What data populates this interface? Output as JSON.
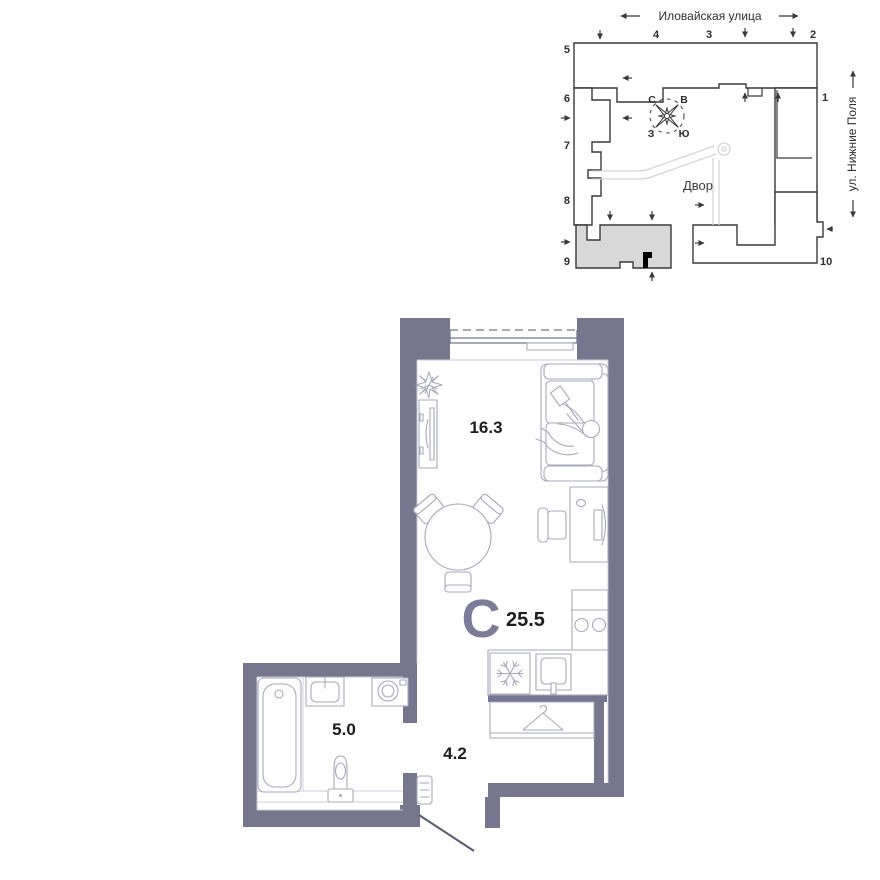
{
  "site_plan": {
    "street_top": {
      "label": "Иловайская улица"
    },
    "street_right": {
      "label": "ул. Нижние Поля"
    },
    "courtyard": {
      "label": "Двор"
    },
    "compass": {
      "north": "С",
      "east": "В",
      "west": "З",
      "south": "Ю"
    },
    "building_numbers": [
      "1",
      "2",
      "3",
      "4",
      "5",
      "6",
      "7",
      "8",
      "9",
      "10"
    ]
  },
  "floor_plan": {
    "apartment_type_letter": "С",
    "total_area": "25.5",
    "rooms": [
      {
        "name": "living-room",
        "area": "16.3"
      },
      {
        "name": "bathroom",
        "area": "5.0"
      },
      {
        "name": "hallway",
        "area": "4.2"
      }
    ]
  },
  "colors": {
    "wall": "#76768f",
    "accent_letter": "#7c7c99",
    "building_outline": "#3a3a3a",
    "selected_building_fill": "#d8d8d8",
    "furniture_line": "#a9a9bc"
  }
}
